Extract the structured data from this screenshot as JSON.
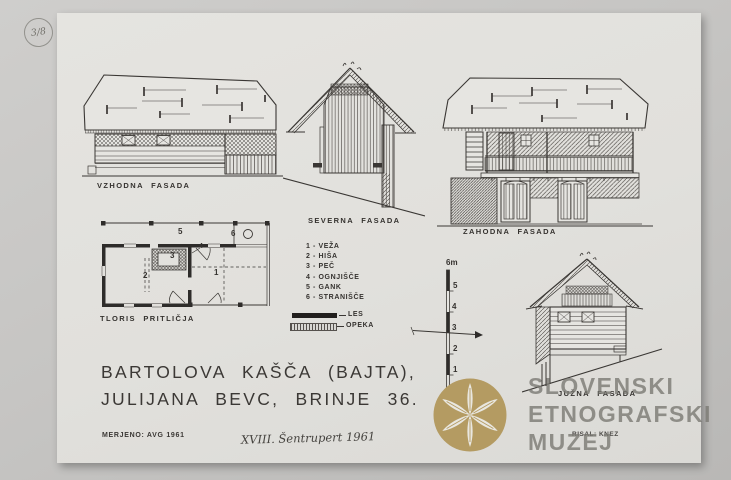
{
  "sheet": {
    "stamp_fraction": "3/8",
    "title_line1": "BARTOLOVA KAŠČA (BAJTA),",
    "title_line2": "JULIJANA BEVC, BRINJE 36.",
    "measured_note": "MERJENO: AVG 1961",
    "handwritten_note": "XVIII. Šentrupert 1961",
    "drawn_by": "RISAL: KNEZ"
  },
  "labels": {
    "east_facade": "VZHODNA FASADA",
    "north_facade": "SEVERNA FASADA",
    "west_facade": "ZAHODNA FASADA",
    "south_facade": "JUŽNA FASADA",
    "floor_plan": "TLORIS PRITLIČJA"
  },
  "legend": {
    "rooms": [
      "1 - VEŽA",
      "2 - HIŠA",
      "3 - PEČ",
      "4 - OGNJIŠČE",
      "5 - GANK",
      "6 - STRANIŠČE"
    ],
    "materials": [
      {
        "label": "LES",
        "swatch": "solid-black-wood"
      },
      {
        "label": "OPEKA",
        "swatch": "hatched-brick"
      }
    ]
  },
  "plan_numbers": {
    "n1": "1",
    "n2": "2",
    "n3": "3",
    "n4": "4",
    "n5": "5",
    "n6": "6"
  },
  "scale_bar": {
    "top": "6m",
    "t5": "5",
    "t4": "4",
    "t3": "3",
    "t2": "2",
    "t1": "1"
  },
  "watermark": {
    "line1": "SLOVENSKI",
    "line2": "ETNOGRAFSKI",
    "line3": "MUZEJ"
  },
  "colors": {
    "paper": "#e1e0dc",
    "background_gray": "#c6c5c3",
    "ink": "#3a3734",
    "watermark_gold": "#b49b62",
    "watermark_text_gray": "#7a7973"
  }
}
